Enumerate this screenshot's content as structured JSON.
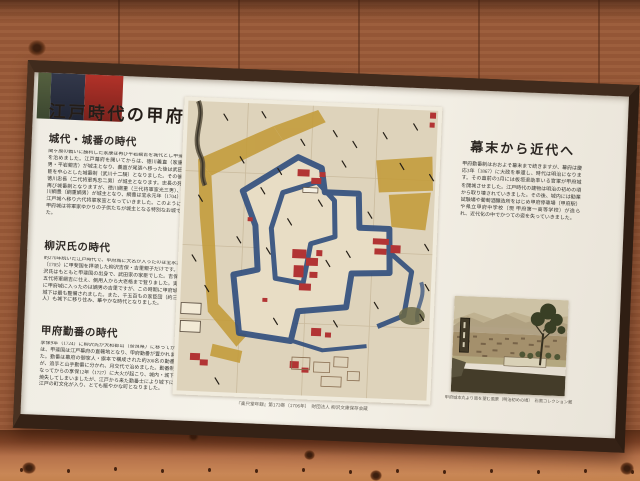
{
  "sign": {
    "title": "江戸時代の甲府城",
    "sections": [
      {
        "heading": "城代・城番の時代",
        "body": "関ヶ原の戦いに勝利した家康は再び平岩親吉を城代とし甲斐国を治めました。江戸幕府を開いてからは、徳川義直（家康九男・平岩親吉）が城主となり、義直が尾張へ移った後は武田遺臣を中心とした城番制（武川十二騎）となりました。その後、徳川忠長（二代将軍秀忠二男）が城主となります。忠長の死後再び城番制となりますが、徳川綱重（三代将軍家光三男）、徳川綱豊（綱重嫡男）が城主となり、綱豊は宝永元年（1704）に江戸城へ移り六代将軍家宣となっていきました。このように、甲府城は将軍家ゆかりの子供たちが城主となる特別なお城でした。"
      },
      {
        "heading": "柳沢氏の時代",
        "body": "約270年続いた江戸時代で、甲府城に大名が入ったのは宝永2年（1705）に甲斐国を拝領した柳沢吉保・吉里親子だけです。柳沢氏はもともと甲斐国の出身で、武田家の家臣でした。吉保は五代将軍綱吉に仕え、側用人から大老格まで登りました。実際に甲府城に入ったのは嫡男の吉里ですが、この時期に甲府城と城下は最も整備されました。また、千五百もの家臣団（約三千人）も城下に移り住み、華やかな時代となりました。"
      },
      {
        "heading": "甲府勤番の時代",
        "body": "享保9年（1724）に柳沢氏が大和郡山（奈良県）に移ってからは、甲斐国は江戸幕府の直轄地となり、甲府勤番が置かれました。勤番は幕府の御家人・旗本で構成された約200名の勤番士が、追手と山手勤番に分かれ、月交代で治めました。勤番制となってからの享保12年（1727）に大火が起こり、城内・城下を焼失してしまいましたが、江戸から来た勤番士により城下には江戸の町文化が入り、とても賑やかな町となりました。"
      }
    ],
    "right_column": {
      "heading": "幕末から近代へ",
      "body": "甲府勤番制はおおよそ幕末まで続きますが、幕府は慶応3年（1867）に大政を奉還し、時代は明治になります。その直前の3月には板垣退助率いる官軍が甲府城を開城させました。江戸時代の建物は明治の初めの頃から取り壊されていきました。その後、城内には勧業試験場や葡萄酒醸造所をはじめ甲府停車場（甲府駅）や県立甲府中学校（現 甲府第一高等学校）が造られ、近代化の中でかつての姿を失っていきました。"
    },
    "map_caption": "『楽只堂年録』第173巻（1706年）　財団法人 柳沢文庫保存会蔵",
    "photo_caption": "甲府城本丸より南を望む風景（明治初めの頃）　石黒コレクション蔵",
    "colors": {
      "accent_green": "#4f5a3c",
      "accent_navy": "#2b3140",
      "accent_red": "#9e2b23",
      "frame_brown": "#3e2a1d",
      "panel_cream": "#f3f0e8",
      "map_moat_blue": "#2f4d7d",
      "map_road_yellow": "#c39b3a",
      "map_building_red": "#b23434"
    }
  }
}
